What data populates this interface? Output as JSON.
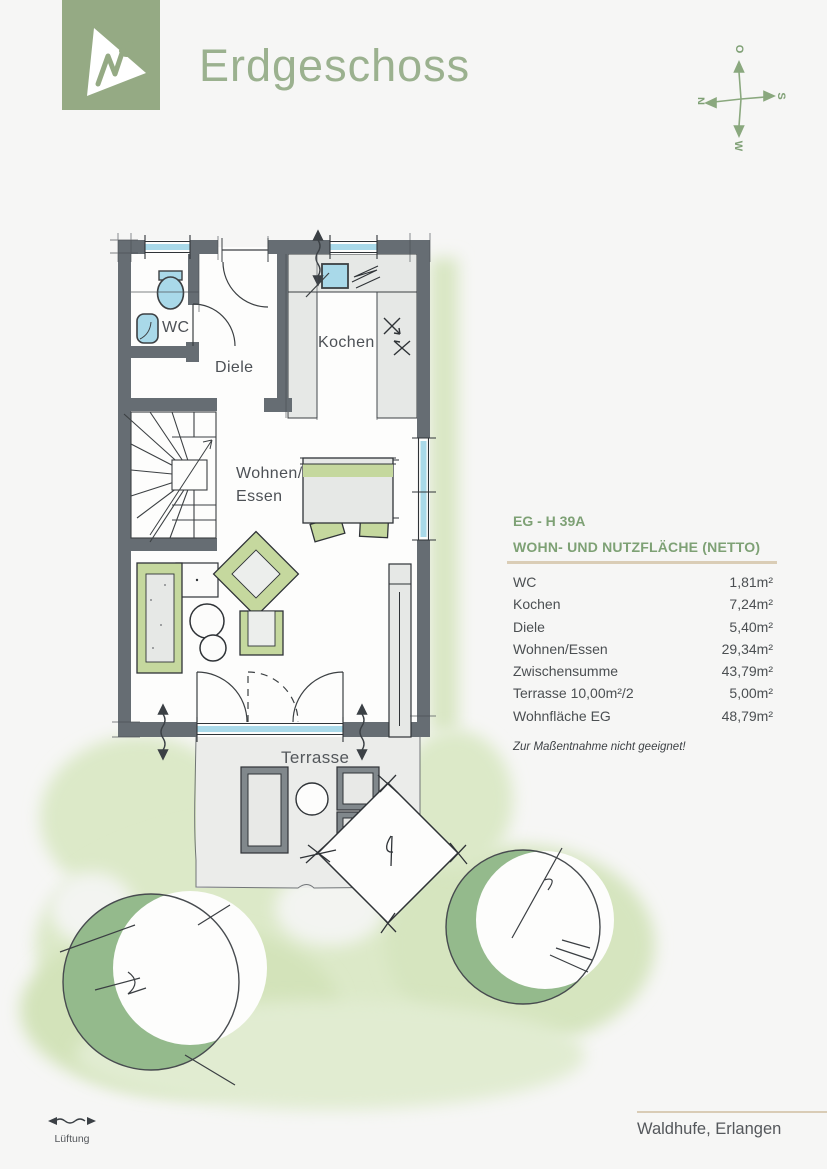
{
  "header": {
    "title": "Erdgeschoss"
  },
  "compass": {
    "north": "N",
    "east": "O",
    "south": "S",
    "west": "W"
  },
  "floor_plan": {
    "rooms": {
      "wc": "WC",
      "diele": "Diele",
      "kochen": "Kochen",
      "wohnen_line1": "Wohnen/",
      "wohnen_line2": "Essen",
      "terrasse": "Terrasse"
    }
  },
  "area_table": {
    "plan_id": "EG - H 39A",
    "heading": "WOHN- UND NUTZFLÄCHE (NETTO)",
    "rows": [
      {
        "label": "WC",
        "value": "1,81m²"
      },
      {
        "label": "Kochen",
        "value": "7,24m²"
      },
      {
        "label": "Diele",
        "value": "5,40m²"
      },
      {
        "label": "Wohnen/Essen",
        "value": "29,34m²"
      },
      {
        "label": "Zwischensumme",
        "value": "43,79m²"
      },
      {
        "label": "Terrasse 10,00m²/2",
        "value": "5,00m²"
      },
      {
        "label": "Wohnfläche EG",
        "value": "48,79m²"
      }
    ],
    "note": "Zur Maßentnahme nicht geeignet!"
  },
  "legend": {
    "lueftung": "Lüftung"
  },
  "footer": {
    "location": "Waldhufe, Erlangen"
  },
  "colors": {
    "accent_green": "#95aa84",
    "title_green": "#9bb18f",
    "table_green": "#7ea175",
    "tan_rule": "#d9ccb6",
    "text_dark": "#4b4f52",
    "wall_gray": "#666d73",
    "window_blue": "#a9d9e9",
    "furniture_green": "#c5d89e",
    "tree_green": "#94ba8c",
    "wash_green": "#dce9c8"
  }
}
